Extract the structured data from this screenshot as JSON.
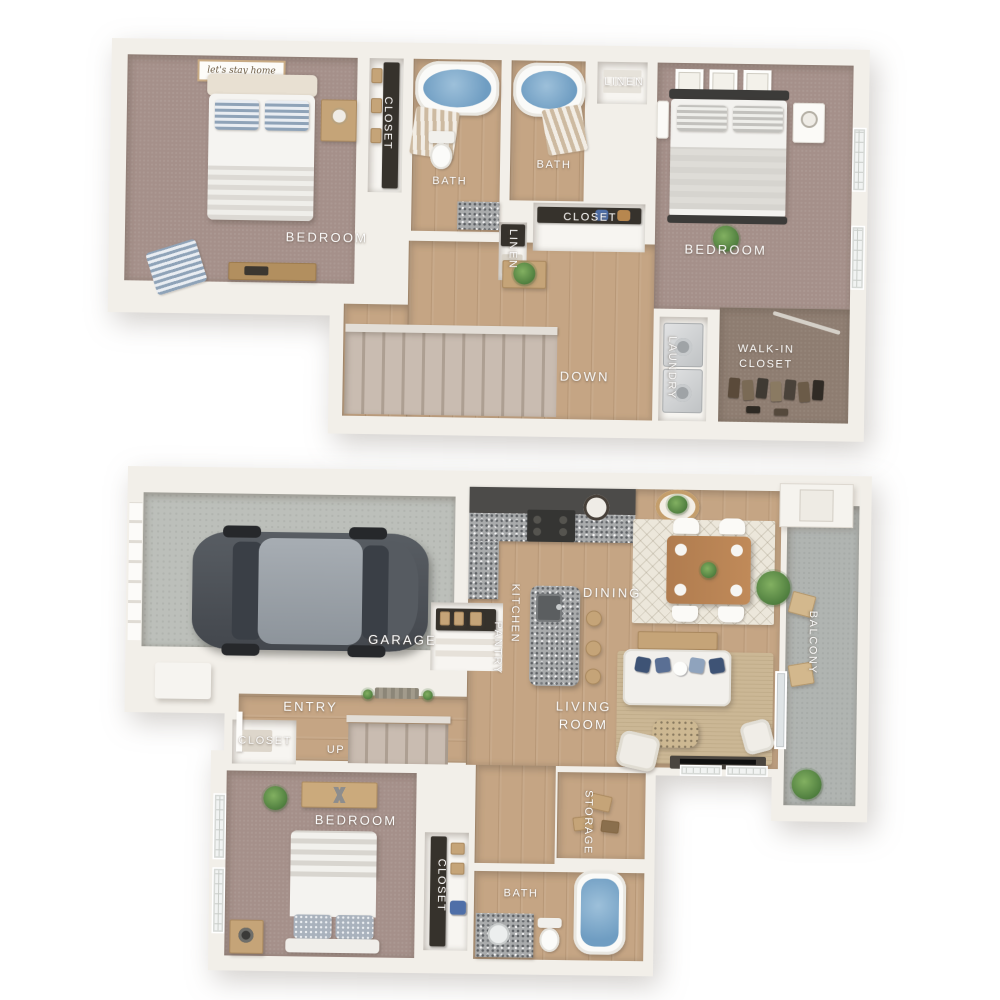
{
  "upper_floor": {
    "bedroom_left": "BEDROOM",
    "closet": "CLOSET",
    "bath_left": "BATH",
    "bath_right": "BATH",
    "linen_top": "LINEN",
    "bedroom_right": "BEDROOM",
    "linen_hall": "LINEN",
    "closet_hall": "CLOSET",
    "stairs_down": "DOWN",
    "laundry": "LAUNDRY",
    "walk_in_closet": "WALK-IN\nCLOSET",
    "bed_sign": "let's stay home"
  },
  "lower_floor": {
    "garage": "GARAGE",
    "pantry": "PANTRY",
    "kitchen": "KITCHEN",
    "dining": "DINING",
    "balcony": "BALCONY",
    "entry": "ENTRY",
    "closet_entry": "CLOSET",
    "stairs_up": "UP",
    "living_room": "LIVING\nROOM",
    "bedroom": "BEDROOM",
    "closet_bedroom": "CLOSET",
    "storage": "STORAGE",
    "bath": "BATH"
  },
  "colors": {
    "wall": "#f2efe9",
    "wall-edge": "#dbd6ce",
    "carpet": "#a5908a",
    "wood": "#c5a584",
    "walkin-floor": "#8e7d71",
    "garage-floor": "#bcbfba",
    "balcony-floor": "#b0b4b1",
    "stair-carpet": "#c9bcb1",
    "granite": "#a9abac",
    "cabinet": "#4c4b49",
    "water": "#6f9dc2",
    "navy": "#3e5375",
    "plant": "#5b8c4a",
    "tan": "#c5a478",
    "rug-jute": "#cbb795",
    "rug-light": "#ece7db",
    "label": "#ffffff"
  }
}
